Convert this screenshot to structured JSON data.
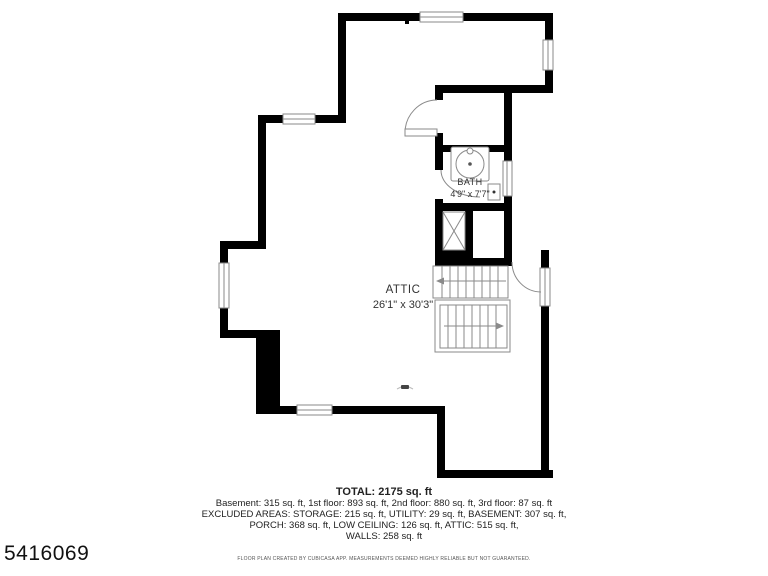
{
  "floor_plan": {
    "rooms": {
      "attic": {
        "name": "ATTIC",
        "dimensions": "26'1\" x 30'3\""
      },
      "bath": {
        "name": "BATH",
        "dimensions": "4'9\" x 7'7\""
      }
    }
  },
  "summary": {
    "total": "TOTAL: 2175 sq. ft",
    "line1": "Basement: 315 sq. ft, 1st floor: 893 sq. ft, 2nd floor: 880 sq. ft, 3rd floor: 87 sq. ft",
    "line2": "EXCLUDED AREAS: STORAGE: 215 sq. ft, UTILITY: 29 sq. ft, BASEMENT: 307 sq. ft,",
    "line3": "PORCH: 368 sq. ft, LOW CEILING: 126 sq. ft, ATTIC: 515 sq. ft,",
    "line4": "WALLS: 258 sq. ft"
  },
  "disclaimer": "FLOOR PLAN CREATED BY CUBICASA APP. MEASUREMENTS DEEMED HIGHLY RELIABLE BUT NOT GUARANTEED.",
  "listing_id": "5416069",
  "colors": {
    "wall": "#000000",
    "thin_line": "#8a8a8a",
    "label_text": "#333333"
  }
}
